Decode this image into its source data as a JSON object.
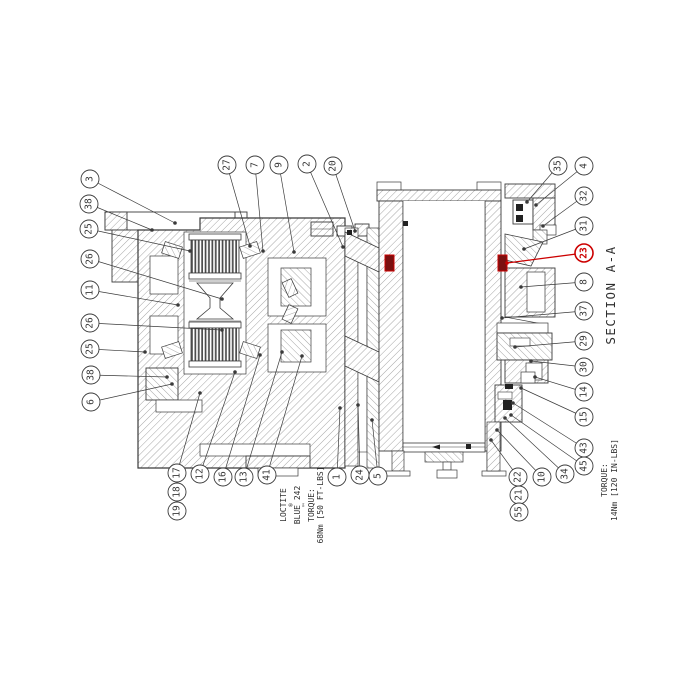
{
  "drawing": {
    "section_label": "SECTION A-A",
    "highlighted_part": "23",
    "colors": {
      "line": "#3a3a3a",
      "hatch": "#8f8f8f",
      "highlight": "#cc0000",
      "highlight_fill": "#7a1010",
      "text": "#2e2e2e"
    },
    "notes": {
      "loctite_lines": [
        "LOCTITE",
        "®",
        "BLUE 242",
        "™",
        "TORQUE:",
        "68Nm [50 FT-LBS]"
      ],
      "torque_lines": [
        "TORQUE:",
        "14Nm [120 IN-LBS]"
      ]
    },
    "balloons": [
      {
        "label": "3",
        "x": 90,
        "y": 179,
        "leader": [
          175,
          223
        ]
      },
      {
        "label": "38",
        "x": 89,
        "y": 204,
        "leader": [
          152,
          230
        ]
      },
      {
        "label": "25",
        "x": 89,
        "y": 229,
        "leader": [
          190,
          251
        ]
      },
      {
        "label": "26",
        "x": 90,
        "y": 259,
        "leader": [
          222,
          299
        ]
      },
      {
        "label": "11",
        "x": 90,
        "y": 290,
        "leader": [
          178,
          305
        ]
      },
      {
        "label": "26",
        "x": 90,
        "y": 323,
        "leader": [
          222,
          330
        ]
      },
      {
        "label": "25",
        "x": 90,
        "y": 349,
        "leader": [
          145,
          352
        ]
      },
      {
        "label": "38",
        "x": 91,
        "y": 375,
        "leader": [
          167,
          377
        ]
      },
      {
        "label": "6",
        "x": 91,
        "y": 402,
        "leader": [
          172,
          384
        ]
      },
      {
        "label": "27",
        "x": 227,
        "y": 165,
        "leader": [
          250,
          246
        ]
      },
      {
        "label": "7",
        "x": 255,
        "y": 165,
        "leader": [
          263,
          251
        ]
      },
      {
        "label": "9",
        "x": 279,
        "y": 165,
        "leader": [
          294,
          252
        ]
      },
      {
        "label": "2",
        "x": 307,
        "y": 164,
        "leader": [
          343,
          247
        ]
      },
      {
        "label": "20",
        "x": 333,
        "y": 166,
        "leader": [
          355,
          231
        ]
      },
      {
        "label": "35",
        "x": 558,
        "y": 166,
        "leader": [
          527,
          202
        ]
      },
      {
        "label": "4",
        "x": 584,
        "y": 166,
        "leader": [
          536,
          205
        ]
      },
      {
        "label": "32",
        "x": 584,
        "y": 196,
        "leader": [
          543,
          226
        ]
      },
      {
        "label": "31",
        "x": 584,
        "y": 226,
        "leader": [
          524,
          249
        ]
      },
      {
        "label": "23",
        "x": 584,
        "y": 253,
        "leader": [
          507,
          263
        ],
        "highlighted": true
      },
      {
        "label": "8",
        "x": 584,
        "y": 282,
        "leader": [
          521,
          287
        ]
      },
      {
        "label": "37",
        "x": 584,
        "y": 311,
        "leader": [
          502,
          318
        ]
      },
      {
        "label": "29",
        "x": 584,
        "y": 341,
        "leader": [
          515,
          347
        ]
      },
      {
        "label": "30",
        "x": 584,
        "y": 367,
        "leader": [
          531,
          361
        ]
      },
      {
        "label": "14",
        "x": 584,
        "y": 392,
        "leader": [
          535,
          377
        ]
      },
      {
        "label": "15",
        "x": 584,
        "y": 417,
        "leader": [
          521,
          388
        ]
      },
      {
        "label": "43",
        "x": 584,
        "y": 448,
        "leader": [
          513,
          403
        ]
      },
      {
        "label": "45",
        "x": 584,
        "y": 466,
        "leader": [
          511,
          415
        ]
      },
      {
        "label": "34",
        "x": 565,
        "y": 474,
        "leader": [
          505,
          418
        ]
      },
      {
        "label": "10",
        "x": 542,
        "y": 477,
        "leader": [
          497,
          430
        ]
      },
      {
        "label": "22",
        "x": 518,
        "y": 477,
        "leader": [
          491,
          440
        ]
      },
      {
        "label": "21",
        "x": 519,
        "y": 495,
        "leader": null
      },
      {
        "label": "55",
        "x": 519,
        "y": 512,
        "leader": null
      },
      {
        "label": "17",
        "x": 177,
        "y": 473,
        "leader": [
          200,
          393
        ]
      },
      {
        "label": "18",
        "x": 177,
        "y": 492,
        "leader": null
      },
      {
        "label": "19",
        "x": 177,
        "y": 511,
        "leader": null
      },
      {
        "label": "12",
        "x": 200,
        "y": 474,
        "leader": [
          235,
          372
        ]
      },
      {
        "label": "16",
        "x": 223,
        "y": 477,
        "leader": [
          260,
          355
        ]
      },
      {
        "label": "13",
        "x": 244,
        "y": 477,
        "leader": [
          282,
          352
        ]
      },
      {
        "label": "41",
        "x": 267,
        "y": 475,
        "leader": [
          302,
          356
        ]
      },
      {
        "label": "1",
        "x": 337,
        "y": 477,
        "leader": [
          340,
          408
        ]
      },
      {
        "label": "24",
        "x": 360,
        "y": 475,
        "leader": [
          358,
          405
        ]
      },
      {
        "label": "5",
        "x": 378,
        "y": 476,
        "leader": [
          372,
          420
        ]
      }
    ]
  }
}
